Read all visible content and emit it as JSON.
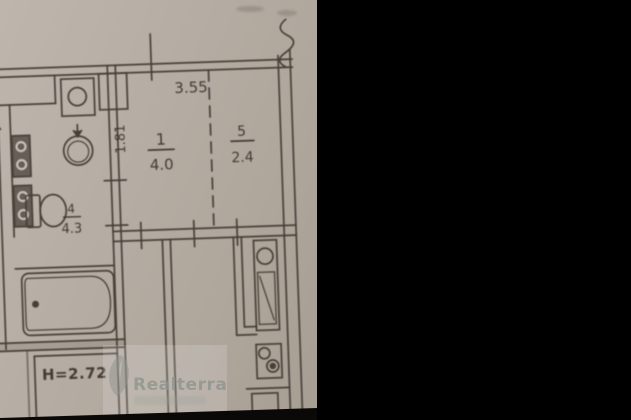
{
  "floorplan": {
    "rooms": [
      {
        "number": "1",
        "area": "4.0"
      },
      {
        "number": "5",
        "area": "2.4"
      },
      {
        "number": "4",
        "area": "4.3"
      }
    ],
    "dimensions": {
      "top_width": "3.55",
      "left_height": "1.81"
    },
    "ceiling_height_label": "H=2.72",
    "watermark": {
      "brand": "Realterra"
    },
    "colors": {
      "background": "#000000",
      "paper": "#b4aba2",
      "ink": "#474038",
      "watermark": "#8f948e"
    }
  }
}
